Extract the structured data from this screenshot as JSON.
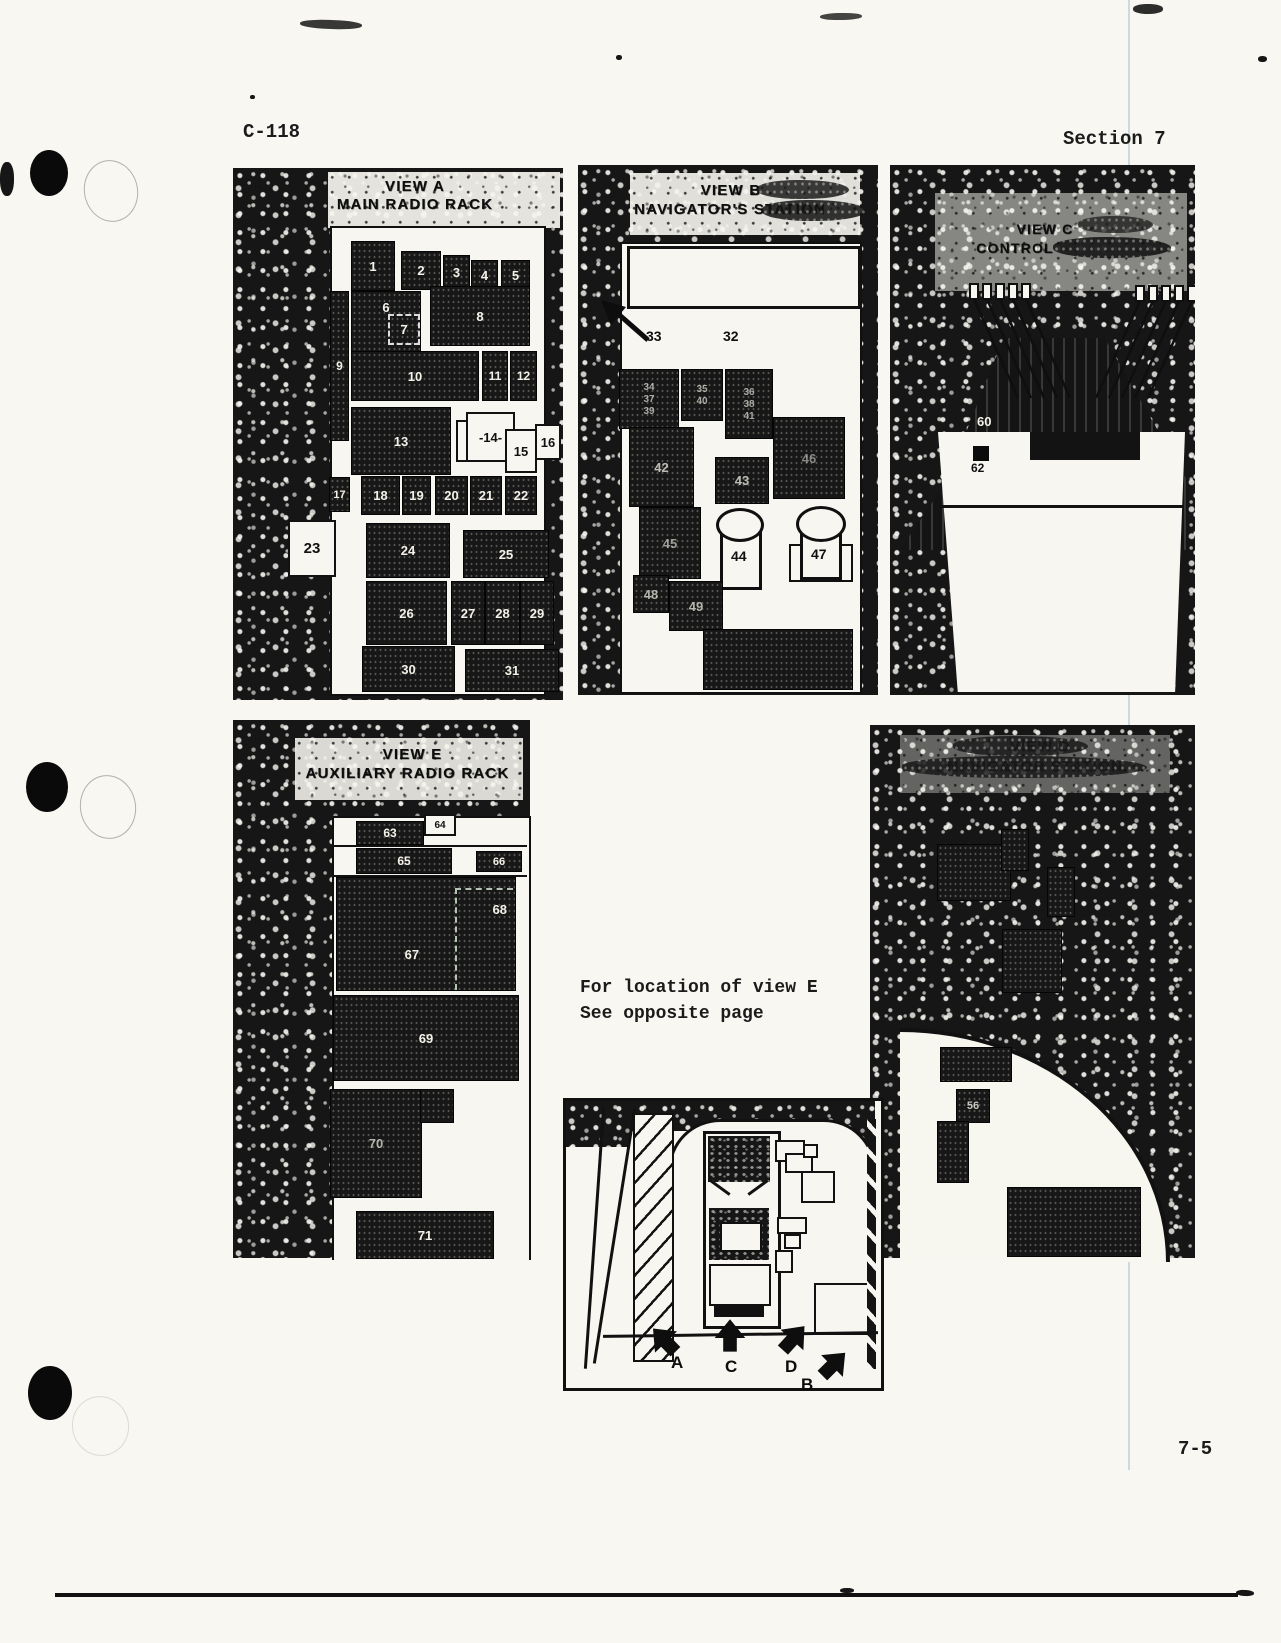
{
  "header": {
    "doc_code": "C-118",
    "section": "Section 7"
  },
  "footer": {
    "page_number": "7-5"
  },
  "note": {
    "line1": "For location of view E",
    "line2": "See opposite page"
  },
  "view_a": {
    "title": "VIEW A",
    "subtitle": "MAIN RADIO RACK",
    "labels": [
      "1",
      "2",
      "3",
      "4",
      "5",
      "6",
      "7",
      "8",
      "9",
      "10",
      "11",
      "12",
      "13",
      "-14-",
      "15",
      "16",
      "17",
      "18",
      "19",
      "20",
      "21",
      "22",
      "23",
      "24",
      "25",
      "26",
      "27",
      "28",
      "29",
      "30",
      "31"
    ]
  },
  "view_b": {
    "title": "VIEW B",
    "subtitle": "NAVIGATOR'S STATION",
    "callout_33": "33",
    "label_32": "32",
    "stack_a": [
      "34",
      "37",
      "39"
    ],
    "stack_b": [
      "35",
      "40"
    ],
    "stack_c": [
      "36",
      "38",
      "41"
    ],
    "label_42": "42",
    "label_43": "43",
    "label_46": "46",
    "label_45": "45",
    "cyl_44": "44",
    "cyl_47": "47",
    "label_48": "48",
    "label_49": "49"
  },
  "view_c": {
    "title": "VIEW C",
    "subtitle": "CONTROL",
    "label_60": "60",
    "label_62": "62"
  },
  "view_d": {
    "title": "VIEW D",
    "subtitle": "NAVIGATOR STATION",
    "label_56": "56"
  },
  "view_e": {
    "title": "VIEW E",
    "subtitle": "AUXILIARY RADIO RACK",
    "labels": [
      "63",
      "64",
      "65",
      "66",
      "67",
      "68",
      "69",
      "70",
      "71"
    ]
  },
  "inset": {
    "arrow_a": "A",
    "arrow_b": "B",
    "arrow_c": "C",
    "arrow_d": "D"
  }
}
